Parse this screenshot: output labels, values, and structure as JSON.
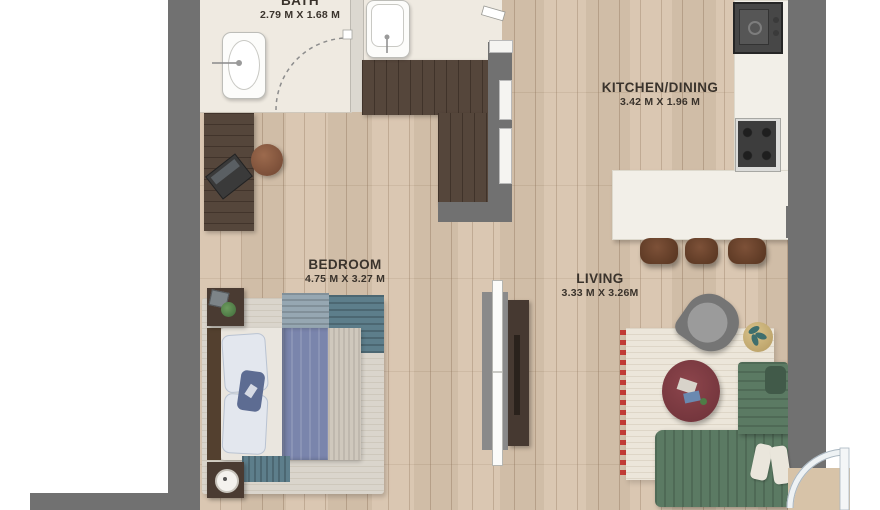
{
  "meta": {
    "type": "apartment floor plan (top-down render)"
  },
  "rooms": {
    "bath": {
      "label": "BATH",
      "dimensions": "2.79 M X 1.68 M"
    },
    "kitchen_dining": {
      "label": "KITCHEN/DINING",
      "dimensions": "3.42 M X 1.96 M"
    },
    "bedroom": {
      "label": "BEDROOM",
      "dimensions": "4.75 M X 3.27 M"
    },
    "living": {
      "label": "LIVING",
      "dimensions": "3.33 M X 3.26M"
    }
  },
  "colors": {
    "wall": "#717171",
    "wood_floor": "#d8c4ad",
    "bath_floor": "#efeae1",
    "dark_wood": "#4e3e33",
    "counter": "#f2efe8",
    "sofa_green": "#5b7a63",
    "duvet_blue": "#7a85ac",
    "rug_cream": "#ece6da",
    "accent_red": "#c23b35",
    "table_maroon": "#7d3a41",
    "label_text": "#3a332c"
  },
  "furniture": [
    "bathroom-sink",
    "vanity-sink",
    "bath-door-swing",
    "entry-door",
    "wardrobe",
    "desk",
    "desk-stool",
    "laptop",
    "double-bed",
    "nightstand-plant",
    "nightstand-lamp",
    "tv-unit",
    "kitchen-sink",
    "cooktop",
    "kitchen-island",
    "bar-stool",
    "armchair",
    "side-table-plant",
    "coffee-table",
    "area-rug",
    "corner-sofa",
    "balcony-door"
  ]
}
